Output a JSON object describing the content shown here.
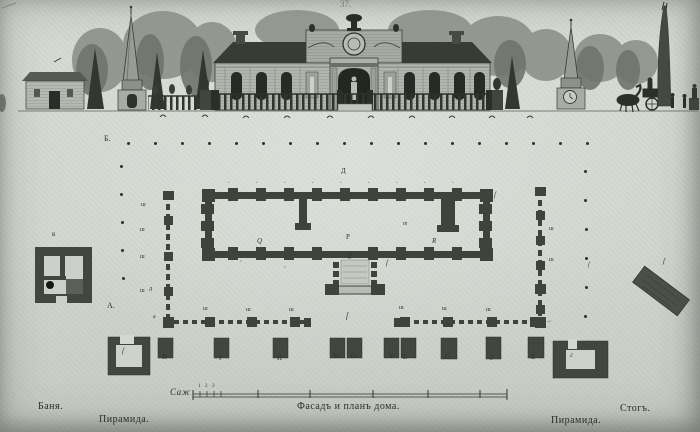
{
  "page_number": "37.",
  "captions": {
    "bath": "Баня.",
    "pyramid_left": "Пирамида.",
    "scale_unit": "Саж",
    "main_title": "Фасадъ и планъ дома.",
    "pyramid_right": "Пирамида.",
    "stack": "Стогъ."
  },
  "scale_bar": {
    "tick_numerals": "1 2 3"
  },
  "colors": {
    "paper": "#d5d8d2",
    "ink": "#2e322b",
    "wall_fill": "#b3b6af",
    "roof_dark": "#383c34",
    "plan_wall": "#3f433b"
  },
  "labels": [
    {
      "x": 104,
      "y": 135,
      "t": "Б.",
      "s": 8
    },
    {
      "x": 341,
      "y": 168,
      "t": "Д",
      "s": 7
    },
    {
      "x": 52,
      "y": 231,
      "t": "в",
      "s": 7
    },
    {
      "x": 107,
      "y": 302,
      "t": "А.",
      "s": 8
    },
    {
      "x": 149,
      "y": 286,
      "t": "д",
      "s": 6
    },
    {
      "x": 153,
      "y": 314,
      "t": "а",
      "s": 6
    },
    {
      "x": 257,
      "y": 238,
      "t": "Q",
      "s": 7,
      "i": 1
    },
    {
      "x": 346,
      "y": 234,
      "t": "Р",
      "s": 7
    },
    {
      "x": 348,
      "y": 254,
      "t": "б",
      "s": 7,
      "i": 1
    },
    {
      "x": 432,
      "y": 238,
      "t": "R",
      "s": 7,
      "i": 1
    },
    {
      "x": 403,
      "y": 221,
      "t": "т",
      "s": 6,
      "i": 1
    },
    {
      "x": 494,
      "y": 192,
      "t": "ſ",
      "s": 7,
      "i": 1
    },
    {
      "x": 346,
      "y": 312,
      "t": "ſ",
      "s": 8,
      "i": 1
    },
    {
      "x": 386,
      "y": 260,
      "t": "ſ",
      "s": 7,
      "i": 1
    },
    {
      "x": 122,
      "y": 348,
      "t": "ſ",
      "s": 7,
      "i": 1
    },
    {
      "x": 570,
      "y": 352,
      "t": "г",
      "s": 7,
      "i": 1
    },
    {
      "x": 588,
      "y": 262,
      "t": "ſ",
      "s": 6,
      "i": 1
    },
    {
      "x": 663,
      "y": 258,
      "t": "ʃ",
      "s": 7,
      "i": 1
    },
    {
      "x": 546,
      "y": 318,
      "t": "→",
      "s": 6
    },
    {
      "x": 240,
      "y": 260,
      "t": "ʻ",
      "s": 6
    },
    {
      "x": 284,
      "y": 266,
      "t": "ʻ",
      "s": 6
    },
    {
      "x": 141,
      "y": 202,
      "t": "ш",
      "s": 6
    },
    {
      "x": 140,
      "y": 227,
      "t": "ш",
      "s": 6
    },
    {
      "x": 140,
      "y": 254,
      "t": "ш",
      "s": 6
    },
    {
      "x": 140,
      "y": 288,
      "t": "ш",
      "s": 6
    },
    {
      "x": 203,
      "y": 306,
      "t": "ш",
      "s": 6
    },
    {
      "x": 246,
      "y": 307,
      "t": "ш",
      "s": 6
    },
    {
      "x": 289,
      "y": 307,
      "t": "ш",
      "s": 6
    },
    {
      "x": 399,
      "y": 305,
      "t": "ш",
      "s": 6
    },
    {
      "x": 442,
      "y": 306,
      "t": "ш",
      "s": 6
    },
    {
      "x": 486,
      "y": 307,
      "t": "ш",
      "s": 6
    },
    {
      "x": 549,
      "y": 226,
      "t": "ш",
      "s": 6
    },
    {
      "x": 549,
      "y": 257,
      "t": "ш",
      "s": 6
    },
    {
      "x": 228,
      "y": 182,
      "t": "ʻ",
      "s": 5
    },
    {
      "x": 256,
      "y": 182,
      "t": "ʻ",
      "s": 5
    },
    {
      "x": 284,
      "y": 182,
      "t": "ʻ",
      "s": 5
    },
    {
      "x": 312,
      "y": 182,
      "t": "ʻ",
      "s": 5
    },
    {
      "x": 340,
      "y": 182,
      "t": "ʻ",
      "s": 5
    },
    {
      "x": 368,
      "y": 182,
      "t": "ʻ",
      "s": 5
    },
    {
      "x": 396,
      "y": 182,
      "t": "ʻ",
      "s": 5
    },
    {
      "x": 424,
      "y": 182,
      "t": "ʻ",
      "s": 5
    },
    {
      "x": 452,
      "y": 182,
      "t": "ʻ",
      "s": 5
    },
    {
      "x": 162,
      "y": 354,
      "t": "К",
      "s": 7
    },
    {
      "x": 219,
      "y": 355,
      "t": "І",
      "s": 7
    },
    {
      "x": 277,
      "y": 355,
      "t": "Н",
      "s": 7
    },
    {
      "x": 333,
      "y": 353,
      "t": "М",
      "s": 7
    },
    {
      "x": 351,
      "y": 353,
      "t": "О",
      "s": 7
    },
    {
      "x": 388,
      "y": 353,
      "t": "N",
      "s": 7
    },
    {
      "x": 403,
      "y": 354,
      "t": "L",
      "s": 7
    },
    {
      "x": 445,
      "y": 354,
      "t": "G",
      "s": 7
    },
    {
      "x": 490,
      "y": 355,
      "t": "F",
      "s": 7
    },
    {
      "x": 531,
      "y": 354,
      "t": "Е",
      "s": 7
    },
    {
      "x": 198,
      "y": 384,
      "t": "1",
      "s": 5
    },
    {
      "x": 205,
      "y": 384,
      "t": "2",
      "s": 5
    },
    {
      "x": 212,
      "y": 384,
      "t": "3",
      "s": 5
    }
  ],
  "dots": [
    {
      "x": 127,
      "y": 142
    },
    {
      "x": 154,
      "y": 142
    },
    {
      "x": 181,
      "y": 142
    },
    {
      "x": 208,
      "y": 142
    },
    {
      "x": 235,
      "y": 142
    },
    {
      "x": 262,
      "y": 142
    },
    {
      "x": 289,
      "y": 142
    },
    {
      "x": 316,
      "y": 142
    },
    {
      "x": 343,
      "y": 142
    },
    {
      "x": 370,
      "y": 142
    },
    {
      "x": 397,
      "y": 142
    },
    {
      "x": 424,
      "y": 142
    },
    {
      "x": 451,
      "y": 142
    },
    {
      "x": 478,
      "y": 142
    },
    {
      "x": 505,
      "y": 142
    },
    {
      "x": 532,
      "y": 142
    },
    {
      "x": 559,
      "y": 142
    },
    {
      "x": 586,
      "y": 142
    },
    {
      "x": 120,
      "y": 165
    },
    {
      "x": 120,
      "y": 193
    },
    {
      "x": 121,
      "y": 221
    },
    {
      "x": 121,
      "y": 249
    },
    {
      "x": 122,
      "y": 277
    },
    {
      "x": 584,
      "y": 170
    },
    {
      "x": 584,
      "y": 199
    },
    {
      "x": 585,
      "y": 228
    },
    {
      "x": 585,
      "y": 257
    },
    {
      "x": 585,
      "y": 286
    },
    {
      "x": 584,
      "y": 315
    }
  ]
}
